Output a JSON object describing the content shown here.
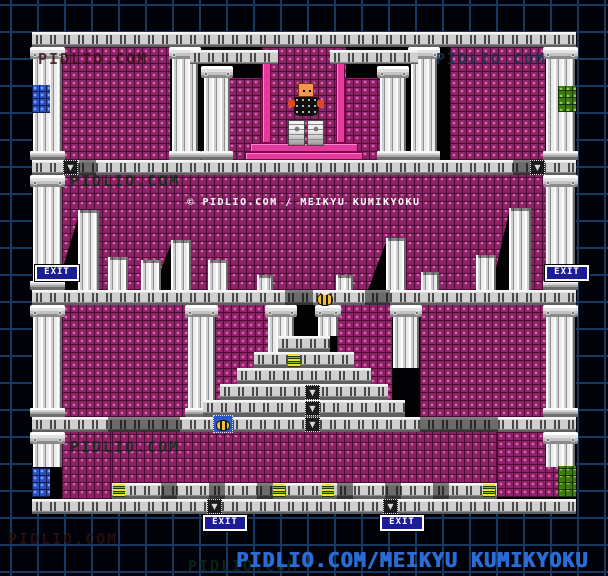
{
  "page": {
    "copyright": "© PIDLIO.COM / MEIKYU KUMIKYOKU",
    "caption": "PIDLIO.COM/MEIKYU KUMIKYOKU",
    "watermark": "PIDLIO.COM",
    "exit_label": "EXIT",
    "icons": {
      "down_arrow": "▼"
    },
    "palette": {
      "background": "#01010a",
      "grid_line": "#16395f",
      "brick_purple": "#8e2268",
      "brick_highlight": "#d863ae",
      "brick_blue": "#2750c0",
      "brick_green": "#3e7a12",
      "stone_light": "#e8e8e8",
      "stone_dark": "#5f5f5f",
      "gate_magenta": "#e43a9e",
      "exit_badge_bg": "#1c1c96",
      "caption_blue": "#2b6cd4",
      "boss_skin": "#f09850"
    }
  }
}
